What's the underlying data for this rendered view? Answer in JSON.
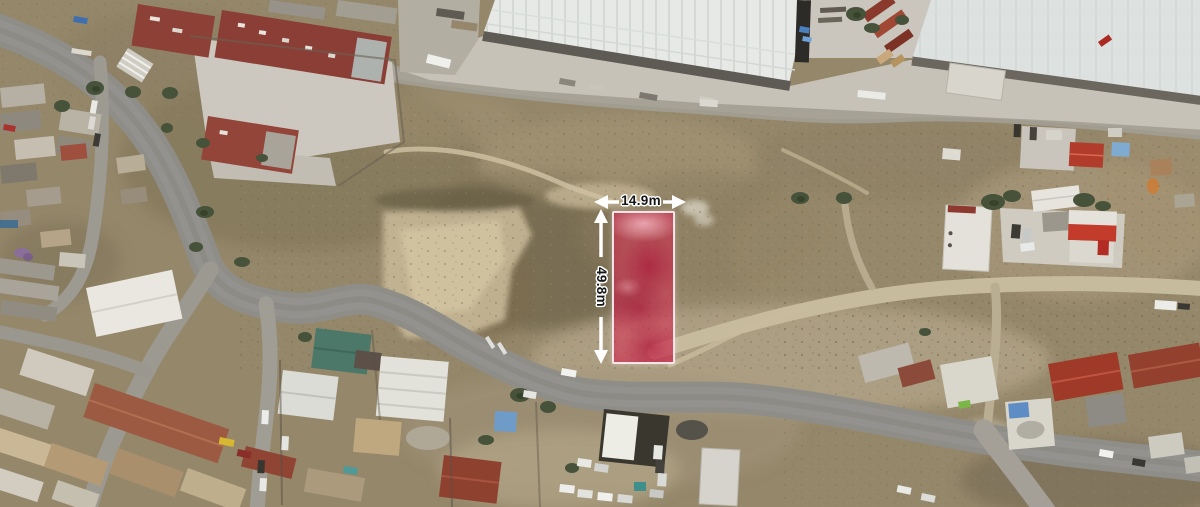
{
  "annotations": {
    "width_label": "14.9m",
    "height_label": "49.8m",
    "arrow_color": "#ffffff",
    "label_text_color": "#161616",
    "label_halo_color": "#ffffff"
  },
  "parcel_overlay": {
    "fill_color": "#e23058",
    "border_color": "#ffeaef"
  }
}
